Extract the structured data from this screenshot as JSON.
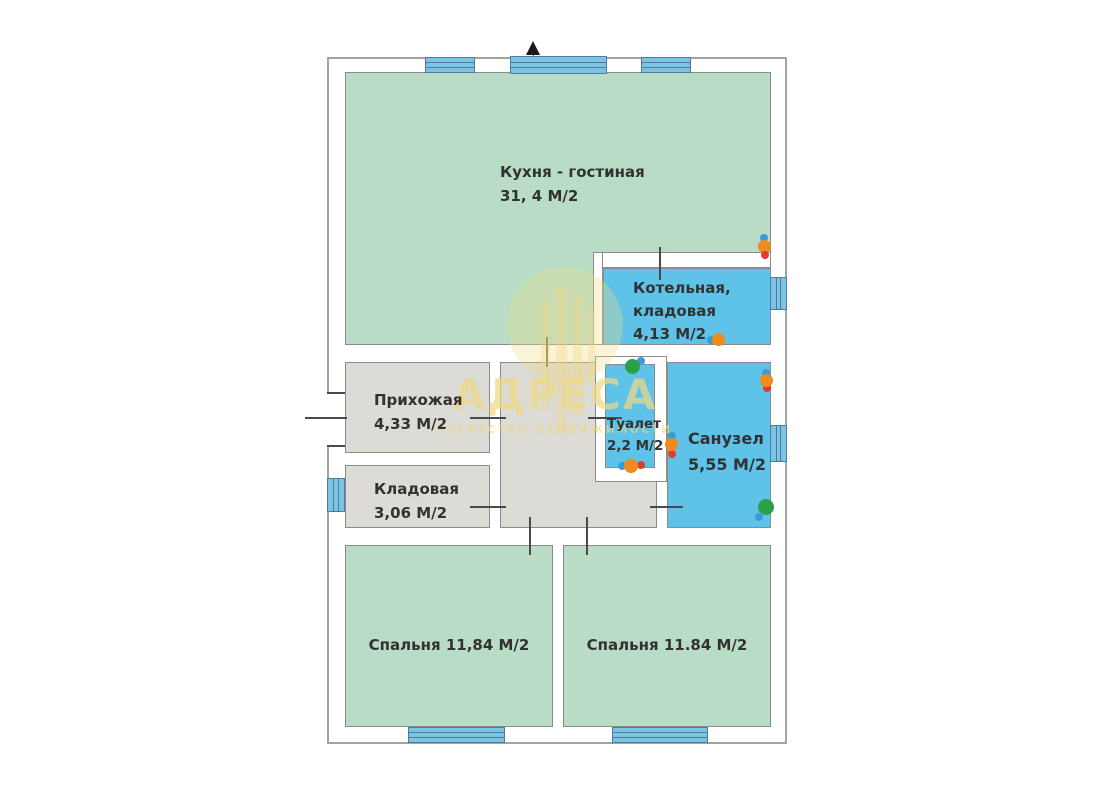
{
  "plan_type": "floor-plan",
  "rooms": {
    "kitchen": {
      "label": "Кухня - гостиная",
      "area": "31, 4 М/2"
    },
    "boiler": {
      "line1": "Котельная,",
      "line2": "кладовая",
      "area": "4,13 М/2"
    },
    "hallway": {
      "label": "Прихожая",
      "area": "4,33 М/2"
    },
    "storage": {
      "label": "Кладовая",
      "area": "3,06 М/2"
    },
    "toilet": {
      "label": "Туалет",
      "area": "2,2 М/2"
    },
    "bathroom": {
      "label": "Санузел",
      "area": "5,55 М/2"
    },
    "bedroom1": {
      "label": "Спальня 11,84  М/2"
    },
    "bedroom2": {
      "label": "Спальня 11.84 М/2"
    }
  },
  "watermark": {
    "title": "АДРЕСА",
    "subtitle": "АГЕНТСТВО НЕДВИЖИМОСТИ"
  },
  "colors": {
    "green": "#b8dcc5",
    "blue": "#5fc2e9",
    "gray": "#dcdbd6",
    "window": "#7cc4e4",
    "window_border": "#4e7d99",
    "wall_line": "#8b8b8b",
    "outline": "#a3a3a3",
    "text": "#323232",
    "wm_color": "#eeda85",
    "fx_orange": "#ef8b1a",
    "fx_green": "#2aa148",
    "fx_blue": "#3b9bd6",
    "fx_red": "#e03c31"
  }
}
